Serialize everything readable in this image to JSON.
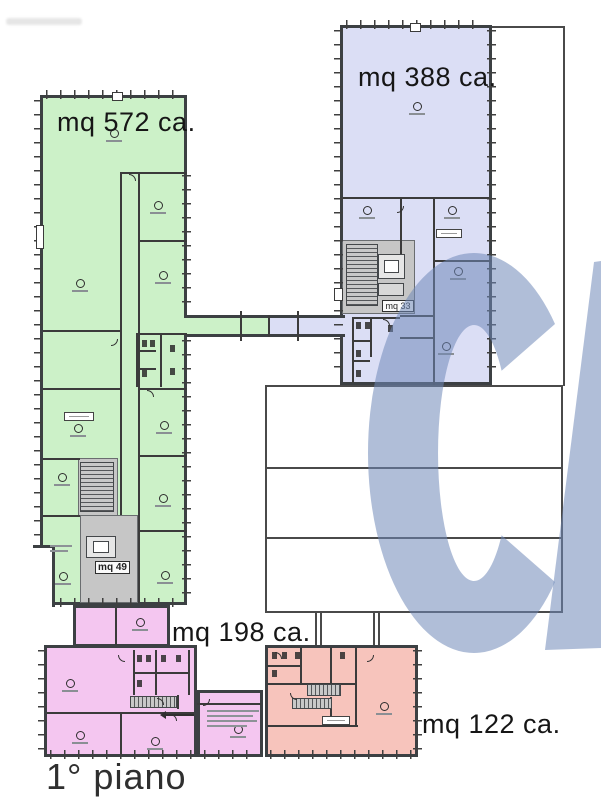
{
  "floor_label": "1° piano",
  "regions": {
    "green": {
      "area_label": "mq 572 ca.",
      "fill": "#ccf1c8"
    },
    "blue": {
      "area_label": "mq 388 ca.",
      "fill": "#dbdef5"
    },
    "pink": {
      "area_label": "mq 198 ca.",
      "fill": "#f4c6f0"
    },
    "salmon": {
      "area_label": "mq 122 ca.",
      "fill": "#f7c4bc"
    }
  },
  "stair_labels": {
    "green_core": "mq 49",
    "blue_core": "mq 33"
  },
  "watermark": {
    "letter": "C",
    "color": "#7089b8"
  },
  "colors": {
    "walls": "#3b3b3b",
    "core_gray": "#c6c6c6",
    "outline": "#4a4a4a"
  }
}
